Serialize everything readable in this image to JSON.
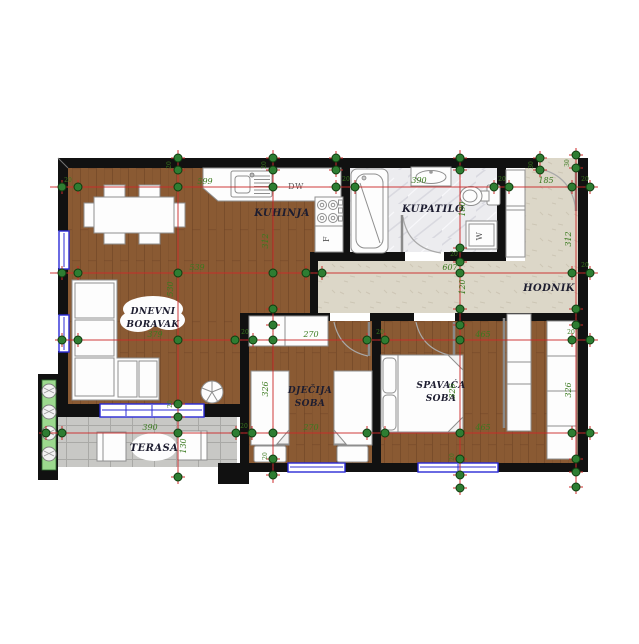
{
  "plan": {
    "rooms": {
      "living": {
        "label_line1": "DNEVNI",
        "label_line2": "BORAVAK"
      },
      "kitchen": {
        "label": "KUHINJA"
      },
      "bathroom": {
        "label": "KUPATILO"
      },
      "hallway": {
        "label": "HODNIK"
      },
      "children_room": {
        "label_line1": "DJEČIJA",
        "label_line2": "SOBA"
      },
      "bedroom": {
        "label_line1": "SPAVAĆA",
        "label_line2": "SOBA"
      },
      "terrace": {
        "label": "TERASA"
      }
    },
    "appliances": {
      "dishwasher": "DW",
      "fridge": "F",
      "washing_machine": "W"
    },
    "dimensions": {
      "horizontal": [
        {
          "text": "599",
          "x": 205,
          "y": 184
        },
        {
          "text": "390",
          "x": 419,
          "y": 183
        },
        {
          "text": "185",
          "x": 546,
          "y": 183
        },
        {
          "text": "539",
          "x": 197,
          "y": 270
        },
        {
          "text": "607",
          "x": 450,
          "y": 270
        },
        {
          "text": "379",
          "x": 155,
          "y": 337
        },
        {
          "text": "270",
          "x": 311,
          "y": 337
        },
        {
          "text": "465",
          "x": 483,
          "y": 337
        },
        {
          "text": "390",
          "x": 150,
          "y": 430
        },
        {
          "text": "270",
          "x": 311,
          "y": 430
        },
        {
          "text": "465",
          "x": 483,
          "y": 430
        }
      ],
      "vertical": [
        {
          "text": "530",
          "x": 173,
          "y": 289
        },
        {
          "text": "312",
          "x": 268,
          "y": 241
        },
        {
          "text": "326",
          "x": 268,
          "y": 389
        },
        {
          "text": "180",
          "x": 465,
          "y": 209
        },
        {
          "text": "120",
          "x": 465,
          "y": 287
        },
        {
          "text": "326",
          "x": 455,
          "y": 391
        },
        {
          "text": "312",
          "x": 571,
          "y": 239
        },
        {
          "text": "326",
          "x": 571,
          "y": 390
        },
        {
          "text": "130",
          "x": 186,
          "y": 446
        }
      ],
      "wall_thickness": [
        {
          "text": "20",
          "x": 68,
          "y": 182,
          "rot": 0
        },
        {
          "text": "20",
          "x": 171,
          "y": 165,
          "rot": 90
        },
        {
          "text": "20",
          "x": 266,
          "y": 165,
          "rot": 90
        },
        {
          "text": "20",
          "x": 346,
          "y": 181,
          "rot": 0
        },
        {
          "text": "20",
          "x": 502,
          "y": 181,
          "rot": 0
        },
        {
          "text": "30",
          "x": 533,
          "y": 165,
          "rot": 90
        },
        {
          "text": "30",
          "x": 569,
          "y": 163,
          "rot": 90
        },
        {
          "text": "20",
          "x": 585,
          "y": 181,
          "rot": 0
        },
        {
          "text": "20",
          "x": 585,
          "y": 267,
          "rot": 0
        },
        {
          "text": "20",
          "x": 454,
          "y": 256,
          "rot": 0
        },
        {
          "text": "20",
          "x": 245,
          "y": 334,
          "rot": 0
        },
        {
          "text": "20",
          "x": 380,
          "y": 334,
          "rot": 0
        },
        {
          "text": "20",
          "x": 571,
          "y": 334,
          "rot": 0
        },
        {
          "text": "20",
          "x": 244,
          "y": 428,
          "rot": 0
        },
        {
          "text": "20",
          "x": 172,
          "y": 404,
          "rot": 90
        },
        {
          "text": "20",
          "x": 267,
          "y": 456,
          "rot": 90
        },
        {
          "text": "20",
          "x": 454,
          "y": 457,
          "rot": 90
        }
      ]
    },
    "markers": [
      [
        62,
        187
      ],
      [
        78,
        187
      ],
      [
        178,
        187
      ],
      [
        273,
        187
      ],
      [
        336,
        187
      ],
      [
        355,
        187
      ],
      [
        494,
        187
      ],
      [
        509,
        187
      ],
      [
        572,
        187
      ],
      [
        590,
        187
      ],
      [
        62,
        273
      ],
      [
        78,
        273
      ],
      [
        178,
        273
      ],
      [
        273,
        273
      ],
      [
        306,
        273
      ],
      [
        322,
        273
      ],
      [
        460,
        273
      ],
      [
        572,
        273
      ],
      [
        590,
        273
      ],
      [
        62,
        340
      ],
      [
        78,
        340
      ],
      [
        178,
        340
      ],
      [
        235,
        340
      ],
      [
        253,
        340
      ],
      [
        273,
        340
      ],
      [
        367,
        340
      ],
      [
        385,
        340
      ],
      [
        460,
        340
      ],
      [
        572,
        340
      ],
      [
        590,
        340
      ],
      [
        46,
        433
      ],
      [
        62,
        433
      ],
      [
        178,
        433
      ],
      [
        236,
        433
      ],
      [
        252,
        433
      ],
      [
        273,
        433
      ],
      [
        367,
        433
      ],
      [
        385,
        433
      ],
      [
        460,
        433
      ],
      [
        572,
        433
      ],
      [
        590,
        433
      ],
      [
        178,
        158
      ],
      [
        178,
        170
      ],
      [
        178,
        404
      ],
      [
        178,
        417
      ],
      [
        178,
        477
      ],
      [
        273,
        158
      ],
      [
        273,
        170
      ],
      [
        273,
        309
      ],
      [
        273,
        325
      ],
      [
        273,
        459
      ],
      [
        273,
        475
      ],
      [
        460,
        158
      ],
      [
        460,
        170
      ],
      [
        460,
        248
      ],
      [
        460,
        262
      ],
      [
        460,
        309
      ],
      [
        460,
        325
      ],
      [
        460,
        459
      ],
      [
        460,
        475
      ],
      [
        460,
        488
      ],
      [
        576,
        155
      ],
      [
        576,
        168
      ],
      [
        576,
        309
      ],
      [
        576,
        325
      ],
      [
        576,
        459
      ],
      [
        576,
        472
      ],
      [
        576,
        487
      ],
      [
        540,
        158
      ],
      [
        540,
        170
      ],
      [
        336,
        158
      ],
      [
        336,
        170
      ]
    ],
    "colors": {
      "wood": "#8a5a33",
      "wood_line": "#6e4425",
      "hall_floor": "#dcd7c8",
      "bath_floor": "#ececef",
      "terrace_tile": "#c8c8c5",
      "planter": "#9cd98e",
      "wall": "#111111",
      "window_blue": "#2b2bd6",
      "dim_line": "#cc2a2a",
      "dim_marker": "#2e7d32",
      "dim_text": "#3a7a1f"
    }
  }
}
